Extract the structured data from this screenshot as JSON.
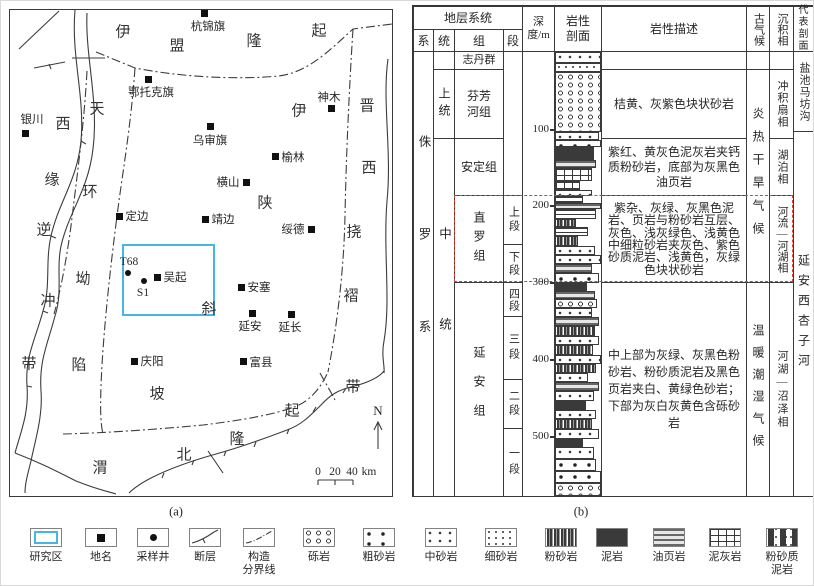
{
  "figure": {
    "panel_a_label": "(a)",
    "panel_b_label": "(b)"
  },
  "colors": {
    "highlight_red": "#e8392e",
    "study_area_blue": "#45b6e8"
  },
  "map": {
    "north_label": "N",
    "scale_bar": {
      "labels": [
        "0",
        "20",
        "40"
      ],
      "unit": "km"
    },
    "study_area": {
      "x": 121,
      "y": 243,
      "w": 93,
      "h": 72
    },
    "cities": [
      {
        "name": "杭锦旗",
        "mx": 203,
        "my": 12,
        "lx": 207,
        "ly": 25
      },
      {
        "name": "鄂托克旗",
        "mx": 147,
        "my": 78,
        "lx": 150,
        "ly": 91
      },
      {
        "name": "银川",
        "mx": 24,
        "my": 132,
        "lx": 31,
        "ly": 118
      },
      {
        "name": "乌审旗",
        "mx": 209,
        "my": 125,
        "lx": 209,
        "ly": 139
      },
      {
        "name": "神木",
        "mx": 330,
        "my": 107,
        "lx": 328,
        "ly": 96
      },
      {
        "name": "榆林",
        "mx": 274,
        "my": 155,
        "lx": 292,
        "ly": 156
      },
      {
        "name": "横山",
        "mx": 245,
        "my": 181,
        "lx": 227,
        "ly": 181
      },
      {
        "name": "定边",
        "mx": 118,
        "my": 215,
        "lx": 136,
        "ly": 215
      },
      {
        "name": "靖边",
        "mx": 204,
        "my": 218,
        "lx": 222,
        "ly": 218
      },
      {
        "name": "绥德",
        "mx": 310,
        "my": 228,
        "lx": 292,
        "ly": 228
      },
      {
        "name": "吴起",
        "mx": 156,
        "my": 276,
        "lx": 174,
        "ly": 276
      },
      {
        "name": "安塞",
        "mx": 240,
        "my": 286,
        "lx": 258,
        "ly": 286
      },
      {
        "name": "延安",
        "mx": 251,
        "my": 312,
        "lx": 249,
        "ly": 325
      },
      {
        "name": "延长",
        "mx": 290,
        "my": 313,
        "lx": 289,
        "ly": 326
      },
      {
        "name": "庆阳",
        "mx": 133,
        "my": 360,
        "lx": 151,
        "ly": 360
      },
      {
        "name": "富县",
        "mx": 242,
        "my": 360,
        "lx": 260,
        "ly": 361
      }
    ],
    "wells": [
      {
        "name": "T68",
        "mx": 127,
        "my": 272,
        "lx": 128,
        "ly": 261
      },
      {
        "name": "S1",
        "mx": 143,
        "my": 280,
        "lx": 142,
        "ly": 292
      }
    ],
    "tectonic_units": [
      {
        "name": "伊盟隆起",
        "chars": [
          {
            "c": "伊",
            "x": 122,
            "y": 30
          },
          {
            "c": "盟",
            "x": 176,
            "y": 44
          },
          {
            "c": "隆",
            "x": 253,
            "y": 39
          },
          {
            "c": "起",
            "x": 318,
            "y": 29
          }
        ]
      },
      {
        "name": "晋西挠褶带",
        "chars": [
          {
            "c": "晋",
            "x": 366,
            "y": 104
          },
          {
            "c": "西",
            "x": 368,
            "y": 166
          },
          {
            "c": "挠",
            "x": 353,
            "y": 230
          },
          {
            "c": "褶",
            "x": 350,
            "y": 294
          },
          {
            "c": "带",
            "x": 352,
            "y": 385
          }
        ]
      },
      {
        "name": "西缘逆冲带",
        "chars": [
          {
            "c": "西",
            "x": 62,
            "y": 122
          },
          {
            "c": "缘",
            "x": 51,
            "y": 178
          },
          {
            "c": "逆",
            "x": 43,
            "y": 228
          },
          {
            "c": "冲",
            "x": 47,
            "y": 299
          },
          {
            "c": "带",
            "x": 28,
            "y": 362
          }
        ]
      },
      {
        "name": "天环坳陷",
        "chars": [
          {
            "c": "天",
            "x": 96,
            "y": 107
          },
          {
            "c": "环",
            "x": 89,
            "y": 190
          },
          {
            "c": "坳",
            "x": 82,
            "y": 277
          },
          {
            "c": "陷",
            "x": 78,
            "y": 363
          }
        ]
      },
      {
        "name": "伊陕斜坡",
        "chars": [
          {
            "c": "伊",
            "x": 298,
            "y": 109
          },
          {
            "c": "陕",
            "x": 264,
            "y": 201
          },
          {
            "c": "斜",
            "x": 208,
            "y": 307
          },
          {
            "c": "坡",
            "x": 156,
            "y": 392
          }
        ]
      },
      {
        "name": "渭北隆起",
        "chars": [
          {
            "c": "渭",
            "x": 99,
            "y": 466
          },
          {
            "c": "北",
            "x": 183,
            "y": 453
          },
          {
            "c": "隆",
            "x": 236,
            "y": 437
          },
          {
            "c": "起",
            "x": 291,
            "y": 409
          }
        ]
      }
    ]
  },
  "strat_table": {
    "header": {
      "strat": "地层系统",
      "xi": "系",
      "tong": "统",
      "zu": "组",
      "duan": "段",
      "depth": "深度/m",
      "lith": "岩性剖面",
      "desc": "岩性描述",
      "paleo": "古气候",
      "sed": "沉积相",
      "ref": "代表剖面"
    },
    "cells": {
      "xi_jurassic": "侏罗系",
      "tong_upper": "上统",
      "tong_middle": "中统",
      "zu_zhidan": "志丹群",
      "zu_fenfang": "芬芳河组",
      "zu_anding": "安定组",
      "zu_zhiluo": "直罗组",
      "zu_yanan": "延安组",
      "duan_shang": "上段",
      "duan_xia": "下段",
      "duan_si": "四段",
      "duan_san": "三段",
      "duan_er": "二段",
      "duan_yi": "一段",
      "desc_fenfang": "桔黄、灰紫色块状砂岩",
      "desc_anding": "紫红、黄灰色泥灰岩夹钙质粉砂岩，底部为灰黑色油页岩",
      "desc_zhiluo": "紫杂、灰绿、灰黑色泥岩、页岩与粉砂岩互层、灰色、浅灰绿色、浅黄色中细粒砂岩夹灰色、紫色砂质泥岩、浅黄色，灰绿色块状砂岩",
      "desc_yanan": "中上部为灰绿、灰黑色粉砂岩、粉砂质泥岩及黑色页岩夹白、黄绿色砂岩；下部为灰白灰黄色含砾砂岩",
      "paleo_hot": "炎热干旱气候",
      "paleo_warm": "温暖潮湿气候",
      "sed_alluvial": "冲积扇相",
      "sed_lake": "湖泊相",
      "sed_river": "河流—河湖相",
      "sed_swamp": "河湖—沼泽相",
      "ref_yanchi": "盐池马坊沟",
      "ref_xingzihe": "延安西杏子河"
    },
    "depth_ticks": [
      {
        "label": "100",
        "y": 127
      },
      {
        "label": "200",
        "y": 203
      },
      {
        "label": "300",
        "y": 280
      },
      {
        "label": "400",
        "y": 357
      },
      {
        "label": "500",
        "y": 434
      }
    ],
    "lithology_blocks": [
      [
        50,
        11,
        "mid",
        100
      ],
      [
        61,
        9,
        "fine",
        100
      ],
      [
        70,
        60,
        "gravel",
        100
      ],
      [
        130,
        8,
        "mid",
        95
      ],
      [
        138,
        7,
        "coarse",
        100
      ],
      [
        145,
        13,
        "mud",
        85
      ],
      [
        158,
        8,
        "dark",
        90
      ],
      [
        166,
        13,
        "marl",
        80
      ],
      [
        179,
        9,
        "marl",
        55
      ],
      [
        188,
        6,
        "mid",
        80
      ],
      [
        194,
        7,
        "lines",
        60
      ],
      [
        201,
        6,
        "dark",
        100
      ],
      [
        207,
        10,
        "lines",
        90
      ],
      [
        217,
        8,
        "silt",
        45
      ],
      [
        225,
        9,
        "lines",
        72
      ],
      [
        234,
        10,
        "silt",
        50
      ],
      [
        244,
        9,
        "mid",
        88
      ],
      [
        253,
        9,
        "mid",
        100
      ],
      [
        262,
        9,
        "dark",
        80
      ],
      [
        271,
        10,
        "coarse",
        95
      ],
      [
        281,
        8,
        "mud",
        70
      ],
      [
        289,
        8,
        "dark",
        88
      ],
      [
        297,
        9,
        "gravel",
        92
      ],
      [
        306,
        9,
        "mid",
        80
      ],
      [
        315,
        9,
        "dark",
        95
      ],
      [
        324,
        10,
        "silt",
        88
      ],
      [
        334,
        9,
        "mid",
        95
      ],
      [
        343,
        10,
        "silt",
        82
      ],
      [
        353,
        9,
        "mid",
        100
      ],
      [
        362,
        9,
        "silt",
        90
      ],
      [
        371,
        9,
        "mid",
        72
      ],
      [
        380,
        9,
        "dark",
        95
      ],
      [
        389,
        10,
        "mid",
        85
      ],
      [
        399,
        9,
        "mud",
        68
      ],
      [
        408,
        9,
        "mid",
        90
      ],
      [
        417,
        10,
        "silt",
        80
      ],
      [
        427,
        10,
        "mid",
        95
      ],
      [
        437,
        8,
        "mud",
        60
      ],
      [
        445,
        12,
        "mid",
        85
      ],
      [
        457,
        12,
        "coarse",
        90
      ],
      [
        469,
        12,
        "coarse",
        100
      ],
      [
        481,
        13,
        "gravel",
        100
      ]
    ]
  },
  "legend": {
    "items": [
      {
        "label": "研究区",
        "symbol": "study-area",
        "x": 45
      },
      {
        "label": "地名",
        "symbol": "place",
        "x": 100
      },
      {
        "label": "采样井",
        "symbol": "well",
        "x": 152
      },
      {
        "label": "断层",
        "symbol": "fault",
        "x": 204
      },
      {
        "label": "构造\n分界线",
        "symbol": "boundary",
        "x": 258
      },
      {
        "label": "砾岩",
        "symbol": "gravel",
        "x": 318
      },
      {
        "label": "粗砂岩",
        "symbol": "coarse",
        "x": 378
      },
      {
        "label": "中砂岩",
        "symbol": "medium",
        "x": 440
      },
      {
        "label": "细砂岩",
        "symbol": "fine",
        "x": 500
      },
      {
        "label": "粉砂岩",
        "symbol": "silt",
        "x": 560
      },
      {
        "label": "泥岩",
        "symbol": "mud",
        "x": 611
      },
      {
        "label": "油页岩",
        "symbol": "oilshale",
        "x": 668
      },
      {
        "label": "泥灰岩",
        "symbol": "marl",
        "x": 724
      },
      {
        "label": "粉砂质\n泥岩",
        "symbol": "siltymud",
        "x": 781
      }
    ]
  }
}
